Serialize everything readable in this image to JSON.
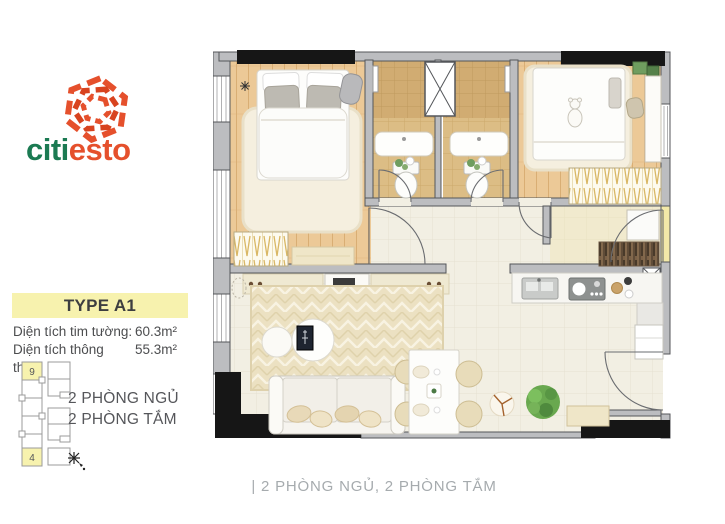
{
  "brand": {
    "name_left": "citi",
    "name_right": "esto"
  },
  "panel": {
    "type_label": "TYPE A1",
    "area_rows": [
      {
        "label": "Diện tích tim tường:",
        "value": "60.3m²"
      },
      {
        "label": "Diện tích thông thủy:",
        "value": "55.3m²"
      }
    ],
    "rooms_line1": "2 PHÒNG NGỦ",
    "rooms_line2": "2 PHÒNG TẮM",
    "keyplan": {
      "unit_top": "9",
      "unit_bottom": "4"
    }
  },
  "caption": "| 2 PHÒNG NGỦ, 2 PHÒNG TẮM",
  "colors": {
    "brand_green": "#1b7a52",
    "brand_orange": "#e5502c",
    "highlight_yellow": "#f7f2ae",
    "wall_gray": "#bcbdc0",
    "wall_black": "#161616",
    "wood_floor": "#ecc997",
    "bath_tile": "#dcbd85",
    "living_tile": "#f2efe3"
  }
}
